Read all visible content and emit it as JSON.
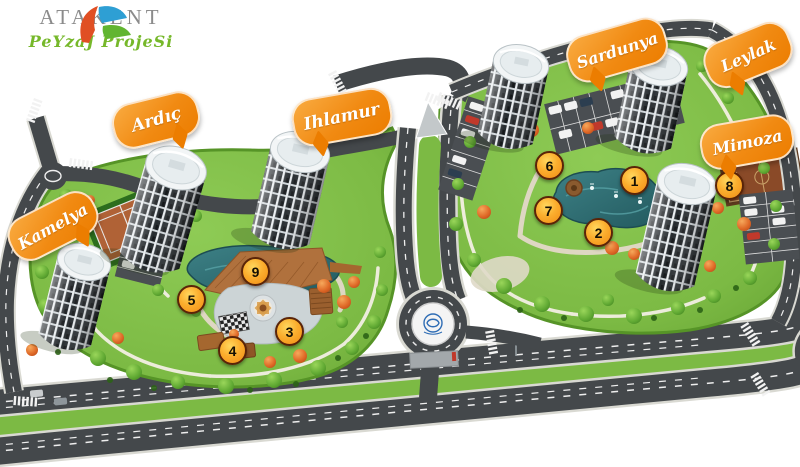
{
  "logo": {
    "title": "ATAKENT",
    "subtitle": "PeYzaJ ProjeSi"
  },
  "map": {
    "building_labels": [
      {
        "id": "kamelya",
        "name": "Kamelya"
      },
      {
        "id": "ardic",
        "name": "Ardıç"
      },
      {
        "id": "ihlamur",
        "name": "Ihlamur"
      },
      {
        "id": "sardunya",
        "name": "Sardunya"
      },
      {
        "id": "leylak",
        "name": "Leylak"
      },
      {
        "id": "mimoza",
        "name": "Mimoza"
      }
    ],
    "markers": [
      {
        "num": "1"
      },
      {
        "num": "2"
      },
      {
        "num": "3"
      },
      {
        "num": "4"
      },
      {
        "num": "5"
      },
      {
        "num": "6"
      },
      {
        "num": "7"
      },
      {
        "num": "8"
      },
      {
        "num": "9"
      }
    ],
    "features": {
      "west_park_pond": "pond with wooden deck",
      "east_park_pond": "pond with fountains",
      "tennis_court": "tennis court",
      "basketball_court": "basketball court",
      "roundabout": "roundabout with emblem"
    }
  },
  "colors": {
    "bubble_orange": "#ec7d00",
    "marker_orange": "#f28c14",
    "lawn_green": "#7cba44",
    "pond_teal": "#2f6e73",
    "road_gray": "#44484b",
    "logo_gray": "#8b8b8b",
    "logo_green": "#76b82a"
  }
}
